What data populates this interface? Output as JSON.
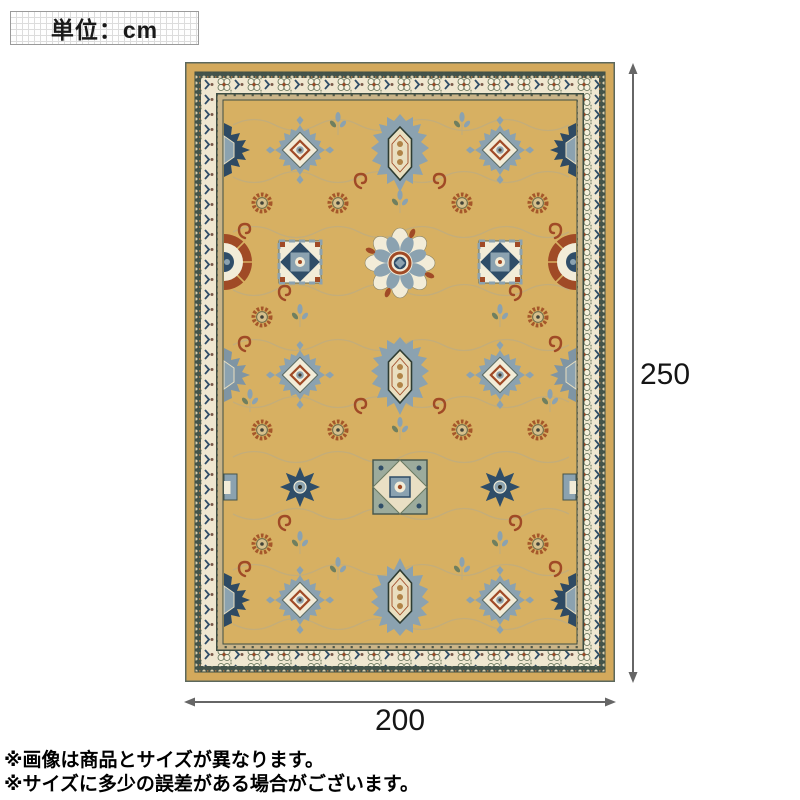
{
  "diagram": {
    "unit_label": "単位：cm",
    "height_label": "250",
    "width_label": "200",
    "note_line1": "※画像は商品とサイズが異なります。",
    "note_line2": "※サイズに多少の誤差がある場合がございます。"
  },
  "product": {
    "kind": "persian-style floral rug",
    "field_style": "all-over medallion and vine pattern on gold ground"
  },
  "colors": {
    "ink": "#111111",
    "arrow": "#666666",
    "edge": "#5c685c",
    "bgold": "#d3a95c",
    "gdark": "#44544b",
    "bcream": "#efe7d0",
    "olive": "#3e4e44",
    "tguard": "#c9b488",
    "gold": "#d7b062",
    "cream": "#f2ecd8",
    "slate": "#8ba2b0",
    "navy": "#2f4d68",
    "rust": "#a04a26",
    "tan": "#c2ad7c"
  }
}
